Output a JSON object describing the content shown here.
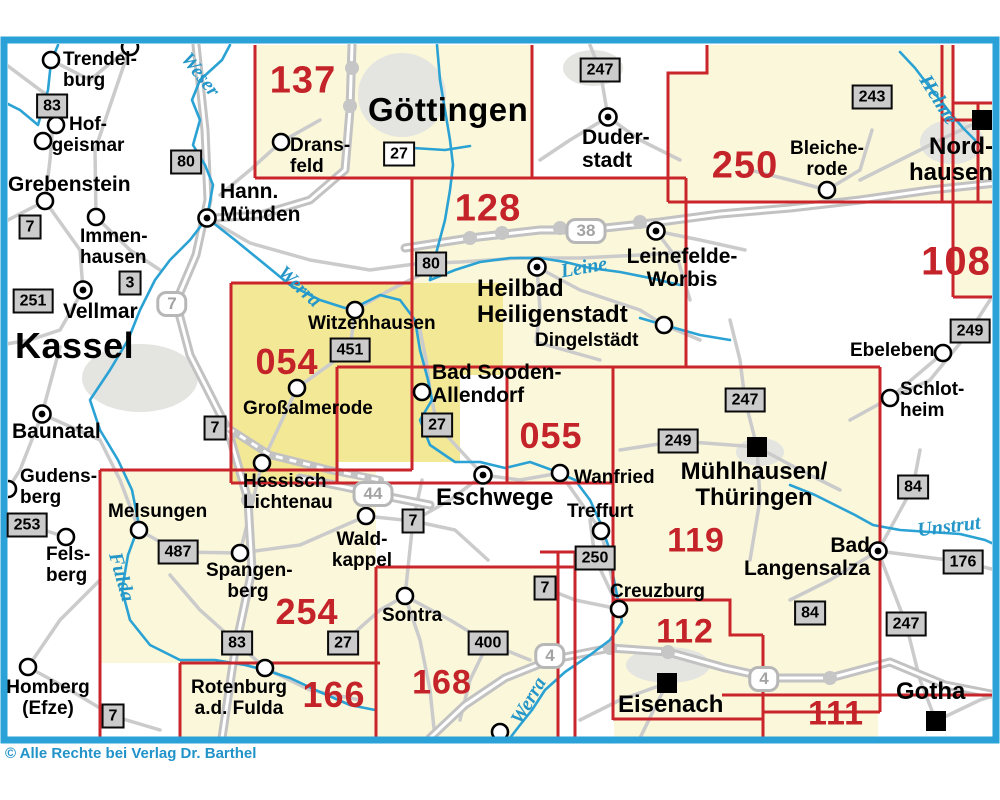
{
  "map": {
    "copyright": "© Alle Rechte bei Verlag Dr. Barthel",
    "colors": {
      "frame_blue": "#2aa1d7",
      "sheet_line_red": "#c9252b",
      "sheet_fill": "#fbf7da",
      "highlight_fill": "#f3e896",
      "river_blue": "#2ba2d4",
      "road_gray": "#cbcbcb"
    },
    "sheet_numbers": [
      {
        "label": "137"
      },
      {
        "label": "128"
      },
      {
        "label": "250"
      },
      {
        "label": "108"
      },
      {
        "label": "054"
      },
      {
        "label": "055"
      },
      {
        "label": "119"
      },
      {
        "label": "254"
      },
      {
        "label": "112"
      },
      {
        "label": "166"
      },
      {
        "label": "168"
      },
      {
        "label": "111"
      }
    ],
    "towns": [
      {
        "name": "Trendelburg",
        "label": "Trendel-\nburg"
      },
      {
        "name": "Hofgeismar",
        "label": "Hof-\ngeismar"
      },
      {
        "name": "Grebenstein",
        "label": "Grebenstein"
      },
      {
        "name": "Hann. Münden",
        "label": "Hann.\nMünden"
      },
      {
        "name": "Immenhausen",
        "label": "Immen-\nhausen"
      },
      {
        "name": "Vellmar",
        "label": "Vellmar"
      },
      {
        "name": "Kassel",
        "label": "Kassel"
      },
      {
        "name": "Baunatal",
        "label": "Baunatal"
      },
      {
        "name": "Gudensberg",
        "label": "Gudens-\nberg"
      },
      {
        "name": "Felsberg",
        "label": "Fels-\nberg"
      },
      {
        "name": "Melsungen",
        "label": "Melsungen"
      },
      {
        "name": "Spangenberg",
        "label": "Spangen-\nberg"
      },
      {
        "name": "Homberg (Efze)",
        "label": "Homberg\n(Efze)"
      },
      {
        "name": "Rotenburg a.d. Fulda",
        "label": "Rotenburg\na.d. Fulda"
      },
      {
        "name": "Sontra",
        "label": "Sontra"
      },
      {
        "name": "Waldkappel",
        "label": "Wald-\nkappel"
      },
      {
        "name": "Hessisch Lichtenau",
        "label": "Hessisch\nLichtenau"
      },
      {
        "name": "Großalmerode",
        "label": "Großalmerode"
      },
      {
        "name": "Witzenhausen",
        "label": "Witzenhausen"
      },
      {
        "name": "Heilbad Heiligenstadt",
        "label": "Heilbad\nHeiligenstadt"
      },
      {
        "name": "Bad Sooden-Allendorf",
        "label": "Bad Sooden-\nAllendorf"
      },
      {
        "name": "Eschwege",
        "label": "Eschwege"
      },
      {
        "name": "Wanfried",
        "label": "Wanfried"
      },
      {
        "name": "Treffurt",
        "label": "Treffurt"
      },
      {
        "name": "Creuzburg",
        "label": "Creuzburg"
      },
      {
        "name": "Dingelstädt",
        "label": "Dingelstädt"
      },
      {
        "name": "Leinefelde-Worbis",
        "label": "Leinefelde-\nWorbis"
      },
      {
        "name": "Duderstadt",
        "label": "Duder-\nstadt"
      },
      {
        "name": "Bleicherode",
        "label": "Bleiche-\nrode"
      },
      {
        "name": "Ebeleben",
        "label": "Ebeleben"
      },
      {
        "name": "Schlotheim",
        "label": "Schlot-\nheim"
      },
      {
        "name": "Nordhausen",
        "label": "Nord-\nhausen"
      },
      {
        "name": "Mühlhausen/Thüringen",
        "label": "Mühlhausen/\nThüringen"
      },
      {
        "name": "Bad Langensalza",
        "label": "Bad\nLangensalza"
      },
      {
        "name": "Eisenach",
        "label": "Eisenach"
      },
      {
        "name": "Gotha",
        "label": "Gotha"
      },
      {
        "name": "Göttingen",
        "label": "Göttingen"
      },
      {
        "name": "Dransfeld",
        "label": "Drans-\nfeld"
      }
    ],
    "road_badges": [
      {
        "label": "83"
      },
      {
        "label": "80"
      },
      {
        "label": "27"
      },
      {
        "label": "247"
      },
      {
        "label": "243"
      },
      {
        "label": "249"
      },
      {
        "label": "7"
      },
      {
        "label": "3"
      },
      {
        "label": "251"
      },
      {
        "label": "451"
      },
      {
        "label": "80"
      },
      {
        "label": "27"
      },
      {
        "label": "249"
      },
      {
        "label": "247"
      },
      {
        "label": "253"
      },
      {
        "label": "487"
      },
      {
        "label": "7"
      },
      {
        "label": "7"
      },
      {
        "label": "83"
      },
      {
        "label": "27"
      },
      {
        "label": "400"
      },
      {
        "label": "7"
      },
      {
        "label": "250"
      },
      {
        "label": "84"
      },
      {
        "label": "176"
      },
      {
        "label": "84"
      },
      {
        "label": "247"
      },
      {
        "label": "7"
      }
    ],
    "motorway_shields": [
      {
        "label": "7"
      },
      {
        "label": "38"
      },
      {
        "label": "44"
      },
      {
        "label": "4"
      },
      {
        "label": "4"
      }
    ],
    "rivers": [
      {
        "label": "Weser"
      },
      {
        "label": "Werra"
      },
      {
        "label": "Leine"
      },
      {
        "label": "Fulda"
      },
      {
        "label": "Werra"
      },
      {
        "label": "Helme"
      },
      {
        "label": "Unstrut"
      }
    ]
  }
}
